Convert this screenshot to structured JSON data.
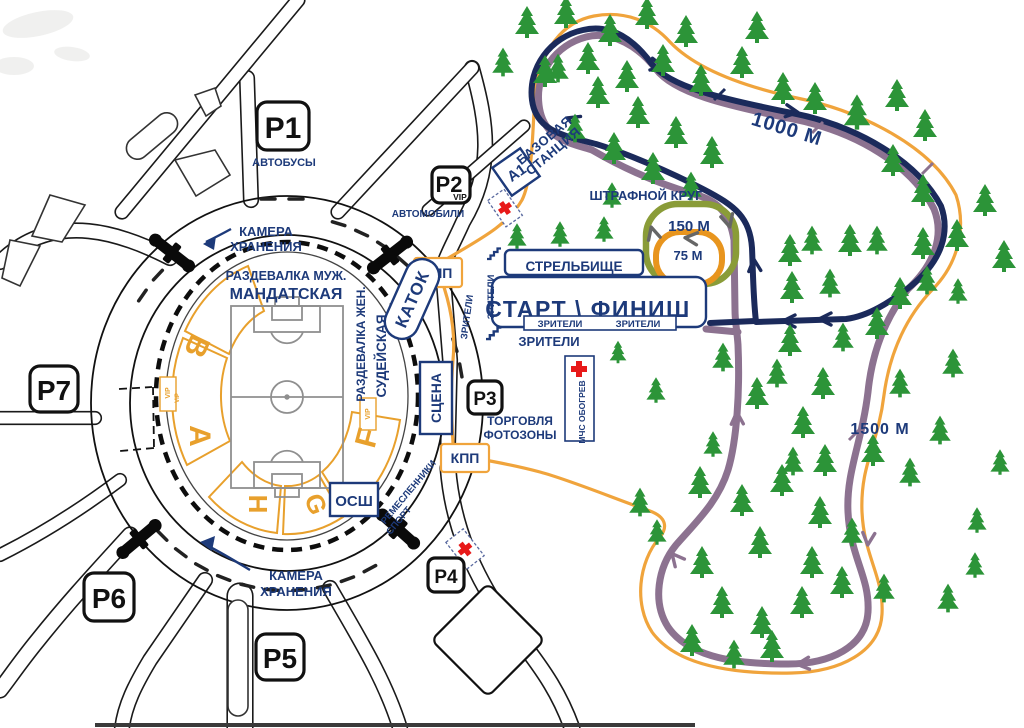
{
  "map": {
    "parking": {
      "p1": "Р1",
      "p2": "Р2",
      "p3": "Р3",
      "p4": "Р4",
      "p5": "Р5",
      "p6": "Р6",
      "p7": "Р7",
      "buses": "АВТОБУСЫ",
      "cars": "АВТОМОБИЛИ",
      "vip": "VIP"
    },
    "checkpoints": {
      "kpp": "КПП",
      "a1": "А1",
      "base_line1": "БАЗОВАЯ",
      "base_line2": "СТАНЦИЯ",
      "osh": "ОСШ"
    },
    "stadium": {
      "dressing_men": "РАЗДЕВАЛКА МУЖ.",
      "mandate": "МАНДАТСКАЯ",
      "dressing_women": "РАЗДЕВАЛКА ЖЕН.",
      "judges": "СУДЕЙСКАЯ",
      "rink": "КАТОК",
      "stage": "СЦЕНА",
      "vip": "VIP",
      "sectors": {
        "a": "A",
        "b": "B",
        "f": "F",
        "g": "G",
        "h": "H"
      }
    },
    "services": {
      "luggage_line1": "КАМЕРА",
      "luggage_line2": "ХРАНЕНИЯ",
      "trade": "ТОРГОВЛЯ",
      "photo": "ФОТОЗОНЫ",
      "mchs": "МЧС ОБОГРЕВ",
      "craftsmen": "РЕМЕСЛЕННИКИ",
      "sport": "СПОРТ"
    },
    "course": {
      "shooting_range": "СТРЕЛЬБИЩЕ",
      "start_finish": "СТАРТ \\ ФИНИШ",
      "spectators": "ЗРИТЕЛИ",
      "penalty_loop": "ШТРАФНОЙ КРУГ",
      "loop_150": "150 М",
      "loop_75": "75 М",
      "trail_1000": "1000 М",
      "trail_1500": "1500 М"
    },
    "colors": {
      "navy": "#1b2a5b",
      "purple": "#8c7290",
      "orange": "#f0a43c",
      "penalty_green": "#8a9c38",
      "penalty_orange": "#e8951e",
      "tree": "#2c9438",
      "label": "#1d3a7a",
      "sector": "#e8a02c",
      "red_cross": "#e81919"
    }
  }
}
